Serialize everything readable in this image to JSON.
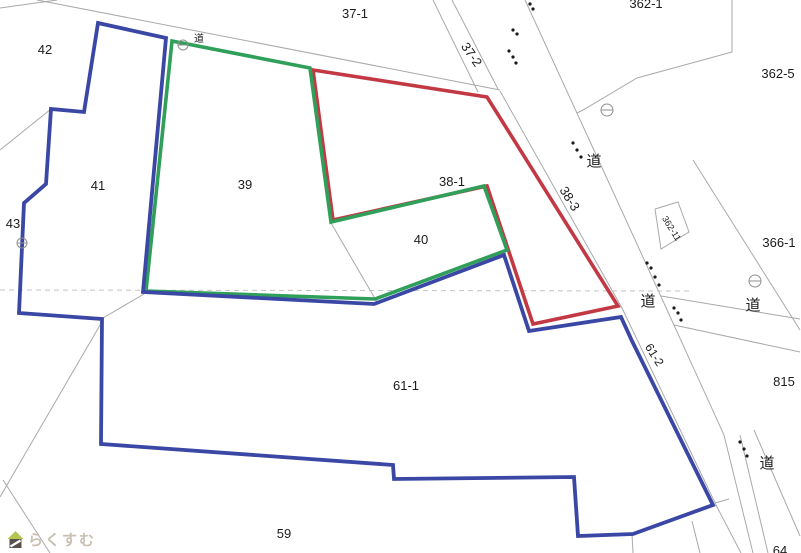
{
  "watermark": {
    "text": "らくすむ",
    "icon": "house-icon"
  },
  "colors": {
    "background": "#ffffff",
    "boundary_red": "#c23944",
    "boundary_green": "#2f9f5a",
    "boundary_blue": "#3a47a5",
    "parcel_line": "#a9a9a9",
    "sheet_dash": "#c4c4c4",
    "label_text": "#1c1c1c",
    "survey_dot": "#1a1a1a",
    "benchmark": "#8f8f8f",
    "watermark_text": "#c9bfb3",
    "watermark_roof": "#b7c44f",
    "watermark_house": "#57524d"
  },
  "labels": [
    {
      "text": "37-1",
      "x": 355,
      "y": 18,
      "size": 13,
      "kind": "parcel"
    },
    {
      "text": "42",
      "x": 45,
      "y": 54,
      "size": 13,
      "kind": "parcel"
    },
    {
      "text": "41",
      "x": 98,
      "y": 190,
      "size": 13,
      "kind": "parcel"
    },
    {
      "text": "43",
      "x": 13,
      "y": 228,
      "size": 13,
      "kind": "parcel"
    },
    {
      "text": "39",
      "x": 245,
      "y": 189,
      "size": 13,
      "kind": "parcel"
    },
    {
      "text": "38-1",
      "x": 452,
      "y": 186,
      "size": 13,
      "kind": "parcel"
    },
    {
      "text": "40",
      "x": 421,
      "y": 244,
      "size": 13,
      "kind": "parcel"
    },
    {
      "text": "37-2",
      "x": 468,
      "y": 57,
      "size": 13,
      "rot": 55,
      "kind": "parcel"
    },
    {
      "text": "38-3",
      "x": 566,
      "y": 201,
      "size": 13,
      "rot": 58,
      "kind": "parcel"
    },
    {
      "text": "362-1",
      "x": 646,
      "y": 8,
      "size": 13,
      "kind": "parcel"
    },
    {
      "text": "362-5",
      "x": 778,
      "y": 78,
      "size": 13,
      "kind": "parcel"
    },
    {
      "text": "362-11",
      "x": 669,
      "y": 230,
      "size": 9,
      "rot": 58,
      "kind": "parcel"
    },
    {
      "text": "366-1",
      "x": 779,
      "y": 247,
      "size": 13,
      "kind": "parcel"
    },
    {
      "text": "815",
      "x": 784,
      "y": 386,
      "size": 13,
      "kind": "parcel"
    },
    {
      "text": "61-2",
      "x": 651,
      "y": 357,
      "size": 12,
      "rot": 58,
      "kind": "parcel"
    },
    {
      "text": "61-1",
      "x": 406,
      "y": 390,
      "size": 13,
      "kind": "parcel"
    },
    {
      "text": "59",
      "x": 284,
      "y": 538,
      "size": 13,
      "kind": "parcel"
    },
    {
      "text": "64",
      "x": 780,
      "y": 555,
      "size": 13,
      "kind": "parcel"
    },
    {
      "text": "道",
      "x": 199,
      "y": 42,
      "size": 10,
      "kind": "road"
    },
    {
      "text": "道",
      "x": 594,
      "y": 166,
      "size": 15,
      "kind": "road"
    },
    {
      "text": "道",
      "x": 648,
      "y": 306,
      "size": 15,
      "kind": "road"
    },
    {
      "text": "道",
      "x": 753,
      "y": 310,
      "size": 15,
      "kind": "road"
    },
    {
      "text": "道",
      "x": 767,
      "y": 468,
      "size": 15,
      "kind": "road"
    }
  ],
  "boundaries": [
    {
      "name": "red",
      "color": "boundary_red",
      "width": 3.6,
      "closed": true,
      "points": [
        [
          313,
          70
        ],
        [
          487,
          97
        ],
        [
          618,
          306
        ],
        [
          533,
          324
        ],
        [
          487,
          186
        ],
        [
          333,
          220
        ]
      ]
    },
    {
      "name": "green",
      "color": "boundary_green",
      "width": 3.6,
      "closed": true,
      "points": [
        [
          172,
          41
        ],
        [
          310,
          68
        ],
        [
          331,
          222
        ],
        [
          484,
          186
        ],
        [
          507,
          250
        ],
        [
          375,
          299
        ],
        [
          146,
          291
        ]
      ]
    },
    {
      "name": "blue",
      "color": "boundary_blue",
      "width": 3.8,
      "closed": true,
      "points": [
        [
          98,
          23
        ],
        [
          166,
          38
        ],
        [
          143,
          292
        ],
        [
          374,
          304
        ],
        [
          504,
          255
        ],
        [
          529,
          331
        ],
        [
          621,
          317
        ],
        [
          632,
          341
        ],
        [
          713,
          505
        ],
        [
          633,
          534
        ],
        [
          578,
          536
        ],
        [
          574,
          477
        ],
        [
          394,
          479
        ],
        [
          393,
          465
        ],
        [
          101,
          444
        ],
        [
          102,
          319
        ],
        [
          19,
          313
        ],
        [
          24,
          203
        ],
        [
          46,
          184
        ],
        [
          51,
          109
        ],
        [
          84,
          112
        ]
      ]
    }
  ],
  "parcel_lines": [
    {
      "points": [
        [
          0,
          8
        ],
        [
          57,
          0
        ]
      ]
    },
    {
      "points": [
        [
          37,
          0
        ],
        [
          500,
          90
        ]
      ]
    },
    {
      "points": [
        [
          433,
          0
        ],
        [
          478,
          92
        ]
      ]
    },
    {
      "points": [
        [
          452,
          0
        ],
        [
          498,
          89
        ]
      ]
    },
    {
      "points": [
        [
          500,
          91
        ],
        [
          622,
          308
        ],
        [
          717,
          507
        ],
        [
          741,
          553
        ]
      ]
    },
    {
      "points": [
        [
          525,
          0
        ],
        [
          593,
          148
        ],
        [
          658,
          290
        ],
        [
          724,
          435
        ],
        [
          753,
          553
        ]
      ]
    },
    {
      "points": [
        [
          732,
          0
        ],
        [
          732,
          52
        ],
        [
          637,
          78
        ],
        [
          583,
          110
        ],
        [
          577,
          113
        ]
      ]
    },
    {
      "points": [
        [
          693,
          160
        ],
        [
          800,
          330
        ]
      ]
    },
    {
      "points": [
        [
          661,
          296
        ],
        [
          800,
          319
        ]
      ]
    },
    {
      "points": [
        [
          674,
          325
        ],
        [
          800,
          352
        ]
      ]
    },
    {
      "points": [
        [
          655,
          209
        ],
        [
          678,
          202
        ],
        [
          689,
          232
        ],
        [
          661,
          249
        ],
        [
          655,
          209
        ]
      ]
    },
    {
      "points": [
        [
          331,
          223
        ],
        [
          377,
          302
        ]
      ]
    },
    {
      "points": [
        [
          103,
          318
        ],
        [
          144,
          294
        ]
      ]
    },
    {
      "points": [
        [
          103,
          320
        ],
        [
          0,
          497
        ]
      ]
    },
    {
      "points": [
        [
          3,
          480
        ],
        [
          50,
          553
        ]
      ]
    },
    {
      "points": [
        [
          0,
          150
        ],
        [
          51,
          109
        ]
      ]
    },
    {
      "points": [
        [
          740,
          435
        ],
        [
          768,
          553
        ]
      ]
    },
    {
      "points": [
        [
          754,
          430
        ],
        [
          800,
          536
        ]
      ]
    },
    {
      "points": [
        [
          715,
          503
        ],
        [
          729,
          499
        ]
      ]
    },
    {
      "points": [
        [
          632,
          534
        ],
        [
          633,
          553
        ]
      ]
    },
    {
      "points": [
        [
          692,
          521
        ],
        [
          700,
          553
        ]
      ]
    }
  ],
  "sheet_line": {
    "points": [
      [
        0,
        290
      ],
      [
        690,
        291
      ]
    ],
    "dash": "5 4"
  },
  "survey_dots": [
    [
      530,
      4
    ],
    [
      533,
      9
    ],
    [
      513,
      30
    ],
    [
      517,
      34
    ],
    [
      509,
      51
    ],
    [
      513,
      57
    ],
    [
      516,
      63
    ],
    [
      573,
      143
    ],
    [
      577,
      150
    ],
    [
      581,
      157
    ],
    [
      647,
      263
    ],
    [
      651,
      268
    ],
    [
      655,
      277
    ],
    [
      659,
      285
    ],
    [
      674,
      308
    ],
    [
      678,
      313
    ],
    [
      681,
      320
    ],
    [
      740,
      442
    ],
    [
      744,
      449
    ],
    [
      747,
      456
    ]
  ],
  "benchmarks": [
    [
      183,
      45,
      5
    ],
    [
      607,
      110,
      6
    ],
    [
      755,
      281,
      6
    ],
    [
      22,
      243,
      5
    ]
  ]
}
